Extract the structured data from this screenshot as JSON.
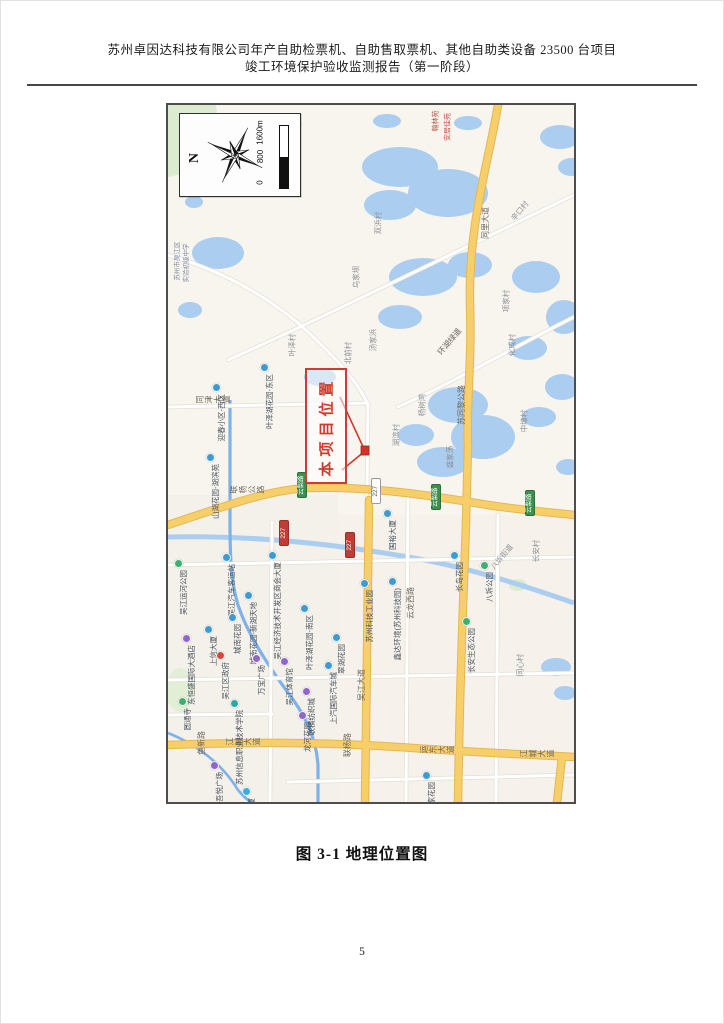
{
  "header": {
    "line1": "苏州卓因达科技有限公司年产自助检票机、自助售取票机、其他自助类设备 23500 台项目",
    "line2": "竣工环境保护验收监测报告（第一阶段）"
  },
  "figure": {
    "caption": "图 3-1 地理位置图"
  },
  "page_number": "5",
  "map": {
    "callout": {
      "label": "本项目位置"
    },
    "legend": {
      "north_label": "N",
      "scale_ticks": [
        "0",
        "800",
        "1600m"
      ]
    },
    "colors": {
      "water": "#aacdf0",
      "land": "#f8f5ef",
      "green_area": "#dcead0",
      "road_yellow": "#f6cf6b",
      "road_casing": "#e6b654",
      "river": "#7fb2e8",
      "callout_red": "#cf3b30",
      "badge_green": "#3d8f4e",
      "badge_red": "#c03c35",
      "poi": {
        "blue": "#3d9bd1",
        "purple": "#9066c9",
        "green": "#3faf6e",
        "teal": "#2aa9a0",
        "cyan": "#35b0d8",
        "red": "#d2493f"
      }
    },
    "area_labels": [
      {
        "t": "乌家坝",
        "x": 188,
        "y": 172
      },
      {
        "t": "双浜村",
        "x": 210,
        "y": 118
      },
      {
        "t": "汤家浜",
        "x": 205,
        "y": 235
      },
      {
        "t": "北前村",
        "x": 180,
        "y": 248
      },
      {
        "t": "叶泽村",
        "x": 124,
        "y": 240
      },
      {
        "t": "辛口村",
        "x": 352,
        "y": 106,
        "dir": "d"
      },
      {
        "t": "项家村",
        "x": 338,
        "y": 196
      },
      {
        "t": "化成村",
        "x": 344,
        "y": 240
      },
      {
        "t": "中塘村",
        "x": 356,
        "y": 316
      },
      {
        "t": "湖滨村",
        "x": 228,
        "y": 330
      },
      {
        "t": "杨树湾",
        "x": 254,
        "y": 300
      },
      {
        "t": "盛家荡",
        "x": 282,
        "y": 352
      },
      {
        "t": "八坼街道",
        "x": 334,
        "y": 452,
        "dir": "d"
      },
      {
        "t": "长安村",
        "x": 368,
        "y": 446
      },
      {
        "t": "同心村",
        "x": 352,
        "y": 560
      },
      {
        "t": "苏州市吴江区",
        "x": 10,
        "y": 156,
        "fs": 6.5,
        "c": "#7d8ea3"
      },
      {
        "t": "实验初级中学",
        "x": 19,
        "y": 158,
        "fs": 6.5,
        "c": "#7d8ea3"
      },
      {
        "t": "翰林苑",
        "x": 268,
        "y": 16,
        "fs": 7,
        "c": "#c0544a"
      },
      {
        "t": "安居佳苑",
        "x": 280,
        "y": 22,
        "fs": 7,
        "c": "#c0544a"
      }
    ],
    "road_labels": [
      {
        "t": "同里大道",
        "x": 318,
        "y": 118,
        "dir": "v"
      },
      {
        "t": "苏同黎公路",
        "x": 294,
        "y": 300,
        "dir": "v"
      },
      {
        "t": "环湖绿道",
        "x": 282,
        "y": 237,
        "dir": "d"
      },
      {
        "t": "同津大道",
        "x": 28,
        "y": 290,
        "dir": "h"
      },
      {
        "t": "联杨公路",
        "x": 62,
        "y": 380,
        "dir": "h"
      },
      {
        "t": "吴江大道",
        "x": 194,
        "y": 580,
        "dir": "v"
      },
      {
        "t": "江城大道",
        "x": 58,
        "y": 632,
        "dir": "h"
      },
      {
        "t": "运东大道",
        "x": 252,
        "y": 640,
        "dir": "h"
      },
      {
        "t": "江城大道",
        "x": 352,
        "y": 644,
        "dir": "h"
      },
      {
        "t": "云龙西路",
        "x": 243,
        "y": 498,
        "dir": "v"
      },
      {
        "t": "联杨路",
        "x": 180,
        "y": 640,
        "dir": "v"
      },
      {
        "t": "鱼新路",
        "x": 34,
        "y": 638,
        "dir": "v"
      }
    ],
    "badges": [
      {
        "t": "云梨路",
        "x": 134,
        "y": 380,
        "c": "green"
      },
      {
        "t": "云梨路",
        "x": 268,
        "y": 392,
        "c": "green"
      },
      {
        "t": "云梨路",
        "x": 362,
        "y": 398,
        "c": "green"
      },
      {
        "t": "227",
        "x": 208,
        "y": 386,
        "c": "white"
      },
      {
        "t": "227",
        "x": 116,
        "y": 428,
        "c": "red"
      },
      {
        "t": "227",
        "x": 182,
        "y": 440,
        "c": "red"
      }
    ],
    "pois": [
      {
        "t": "迎春小区-西区",
        "x": 48,
        "y": 282,
        "c": "blue"
      },
      {
        "t": "叶泽湖花园-东区",
        "x": 96,
        "y": 262,
        "c": "blue"
      },
      {
        "t": "山湖花园-湖滨苑",
        "x": 42,
        "y": 352,
        "c": "blue"
      },
      {
        "t": "吴江运河公园",
        "x": 10,
        "y": 458,
        "c": "green"
      },
      {
        "t": "吴江汽车客运站",
        "x": 58,
        "y": 452,
        "c": "blue"
      },
      {
        "t": "吴江经济技术开发区商会大厦",
        "x": 104,
        "y": 450,
        "c": "blue"
      },
      {
        "t": "城南花园-新湖天地",
        "x": 80,
        "y": 490,
        "c": "blue"
      },
      {
        "t": "城南花园",
        "x": 64,
        "y": 512,
        "c": "blue"
      },
      {
        "t": "叶泽湖花园-南区",
        "x": 136,
        "y": 503,
        "c": "blue"
      },
      {
        "t": "东恒盛国际大酒店",
        "x": 18,
        "y": 533,
        "c": "purple"
      },
      {
        "t": "上信大厦",
        "x": 40,
        "y": 524,
        "c": "blue"
      },
      {
        "t": "吴江区政府",
        "x": 52,
        "y": 550,
        "c": "red"
      },
      {
        "t": "万宝广场",
        "x": 88,
        "y": 553,
        "c": "purple"
      },
      {
        "t": "吴江体育馆",
        "x": 116,
        "y": 556,
        "c": "purple"
      },
      {
        "t": "圆通寺",
        "x": 14,
        "y": 596,
        "c": "green"
      },
      {
        "t": "苏州信息职业技术学院",
        "x": 66,
        "y": 598,
        "c": "teal"
      },
      {
        "t": "吾悦广场",
        "x": 46,
        "y": 660,
        "c": "purple"
      },
      {
        "t": "苏州湾大厦",
        "x": 78,
        "y": 686,
        "c": "cyan"
      },
      {
        "t": "龙河花园",
        "x": 134,
        "y": 610,
        "c": "purple"
      },
      {
        "t": "联横纺织城",
        "x": 138,
        "y": 586,
        "c": "purple"
      },
      {
        "t": "苏州科技工业园",
        "x": 196,
        "y": 478,
        "c": "blue"
      },
      {
        "t": "鑫达环境(苏州科技园)",
        "x": 224,
        "y": 476,
        "c": "blue"
      },
      {
        "t": "国裕大厦",
        "x": 219,
        "y": 408,
        "c": "blue"
      },
      {
        "t": "翠湖花园",
        "x": 168,
        "y": 532,
        "c": "blue"
      },
      {
        "t": "上汽国际汽车城",
        "x": 160,
        "y": 560,
        "c": "blue"
      },
      {
        "t": "长岛花园",
        "x": 286,
        "y": 450,
        "c": "blue"
      },
      {
        "t": "八坼公园",
        "x": 316,
        "y": 460,
        "c": "green"
      },
      {
        "t": "长安生态公园",
        "x": 298,
        "y": 516,
        "c": "green"
      },
      {
        "t": "盛家花园",
        "x": 258,
        "y": 670,
        "c": "blue"
      }
    ]
  }
}
